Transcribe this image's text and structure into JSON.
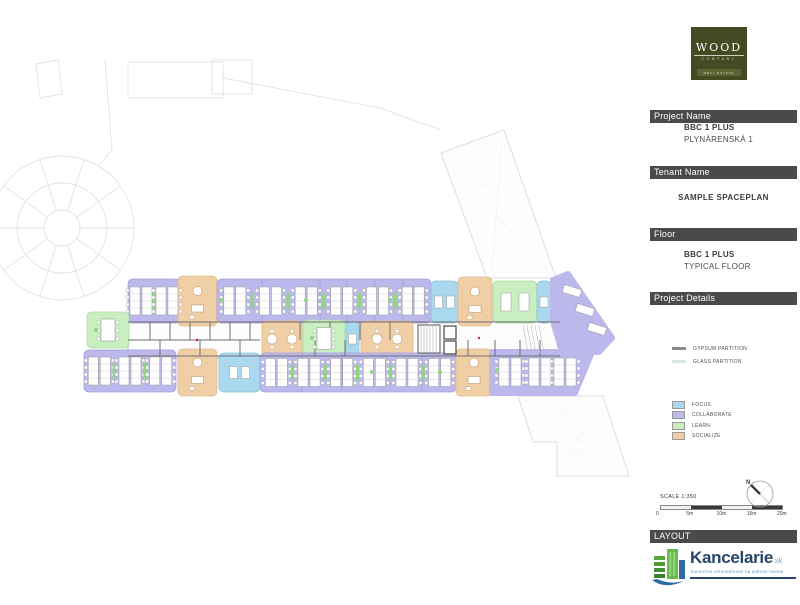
{
  "brand": {
    "name": "WOOD",
    "company": "COMPANY",
    "sub": "REAL ESTATE"
  },
  "sidebar": {
    "project": {
      "header": "Project Name",
      "line1": "BBC 1 PLUS",
      "line2": "PLYNÁRENSKÁ 1"
    },
    "tenant": {
      "header": "Tenant Name",
      "value": "SAMPLE SPACEPLAN"
    },
    "floor": {
      "header": "Floor",
      "line1": "BBC 1 PLUS",
      "line2": "TYPICAL FLOOR"
    },
    "details": {
      "header": "Project Details",
      "partitions": [
        {
          "label": "GYPSUM PARTITION",
          "color": "#8a8a8a"
        },
        {
          "label": "GLASS PARTITION",
          "color": "#d4e8e6"
        }
      ],
      "zone_legend": [
        {
          "key": "focus",
          "label": "FOCUS",
          "color": "#aad8ee"
        },
        {
          "key": "collaborate",
          "label": "COLLABORATE",
          "color": "#bcb8ec"
        },
        {
          "key": "learn",
          "label": "LEARN",
          "color": "#c9efc1"
        },
        {
          "key": "socialize",
          "label": "SOCIALIZE",
          "color": "#f1cfa6"
        }
      ]
    },
    "layout_header": "LAYOUT",
    "scale": {
      "label": "SCALE 1:350",
      "ticks": [
        "0",
        "5m",
        "10m",
        "15m",
        "20m"
      ]
    },
    "compass": {
      "label": "N"
    }
  },
  "footer_logo": {
    "name": "Kancelarie",
    "tld": ".sk",
    "tagline": "komerčné nehnuteľnosti na jednom mieste"
  },
  "floorplan": {
    "palette": {
      "focus": {
        "fill": "#aad8ee",
        "stroke": "#8cc2de"
      },
      "collaborate": {
        "fill": "#bcb8ec",
        "stroke": "#a29ddd"
      },
      "learn": {
        "fill": "#c9efc1",
        "stroke": "#a9dd9f"
      },
      "socialize": {
        "fill": "#f1cfa6",
        "stroke": "#e3b98c"
      }
    },
    "wall_color": "#6e6e6e",
    "site_color": "#e2e2e8",
    "zones": [
      {
        "shape": "rect",
        "type": "collaborate",
        "x": 128,
        "y": 279,
        "w": 52,
        "h": 44,
        "furn": "bench:2"
      },
      {
        "shape": "rect",
        "type": "socialize",
        "x": 178,
        "y": 276,
        "w": 39,
        "h": 50,
        "furn": "lounge"
      },
      {
        "shape": "rect",
        "type": "collaborate",
        "x": 217,
        "y": 279,
        "w": 214,
        "h": 44,
        "furn": "bench:6",
        "dividers": [
          262,
          320,
          347,
          375,
          403
        ]
      },
      {
        "shape": "rect",
        "type": "focus",
        "x": 431,
        "y": 281,
        "w": 27,
        "h": 42,
        "furn": "desk2"
      },
      {
        "shape": "rect",
        "type": "socialize",
        "x": 458,
        "y": 277,
        "w": 34,
        "h": 49,
        "furn": "lounge"
      },
      {
        "shape": "rect",
        "type": "learn",
        "x": 493,
        "y": 281,
        "w": 44,
        "h": 42,
        "furn": "table2"
      },
      {
        "shape": "rect",
        "type": "focus",
        "x": 537,
        "y": 281,
        "w": 14,
        "h": 42,
        "furn": "desk"
      },
      {
        "shape": "poly",
        "type": "collaborate",
        "pts": [
          [
            553,
            280
          ],
          [
            568,
            274
          ],
          [
            612,
            338
          ],
          [
            599,
            352
          ],
          [
            562,
            352
          ],
          [
            553,
            321
          ]
        ],
        "furn": "angled"
      },
      {
        "shape": "rect",
        "type": "learn",
        "x": 87,
        "y": 312,
        "w": 42,
        "h": 36,
        "furn": "bigtable"
      },
      {
        "shape": "rect",
        "type": "socialize",
        "x": 262,
        "y": 321,
        "w": 40,
        "h": 36,
        "furn": "round2"
      },
      {
        "shape": "rect",
        "type": "learn",
        "x": 303,
        "y": 320,
        "w": 42,
        "h": 37,
        "furn": "bigtable"
      },
      {
        "shape": "rect",
        "type": "focus",
        "x": 346,
        "y": 322,
        "w": 13,
        "h": 34,
        "furn": "desk"
      },
      {
        "shape": "rect",
        "type": "socialize",
        "x": 361,
        "y": 321,
        "w": 52,
        "h": 36,
        "furn": "round2"
      },
      {
        "shape": "rect",
        "type": "collaborate",
        "x": 84,
        "y": 350,
        "w": 92,
        "h": 42,
        "furn": "bench:3"
      },
      {
        "shape": "rect",
        "type": "socialize",
        "x": 178,
        "y": 349,
        "w": 39,
        "h": 47,
        "furn": "lounge"
      },
      {
        "shape": "rect",
        "type": "focus",
        "x": 219,
        "y": 353,
        "w": 41,
        "h": 39,
        "furn": "desk2"
      },
      {
        "shape": "rect",
        "type": "collaborate",
        "x": 260,
        "y": 353,
        "w": 196,
        "h": 39,
        "furn": "bench:6",
        "dividers": [
          302,
          342,
          382,
          422
        ]
      },
      {
        "shape": "rect",
        "type": "socialize",
        "x": 456,
        "y": 349,
        "w": 36,
        "h": 47,
        "furn": "lounge"
      },
      {
        "shape": "poly",
        "type": "collaborate",
        "pts": [
          [
            492,
            352
          ],
          [
            592,
            352
          ],
          [
            575,
            393
          ],
          [
            492,
            393
          ]
        ],
        "furn": "bench3p"
      }
    ]
  }
}
